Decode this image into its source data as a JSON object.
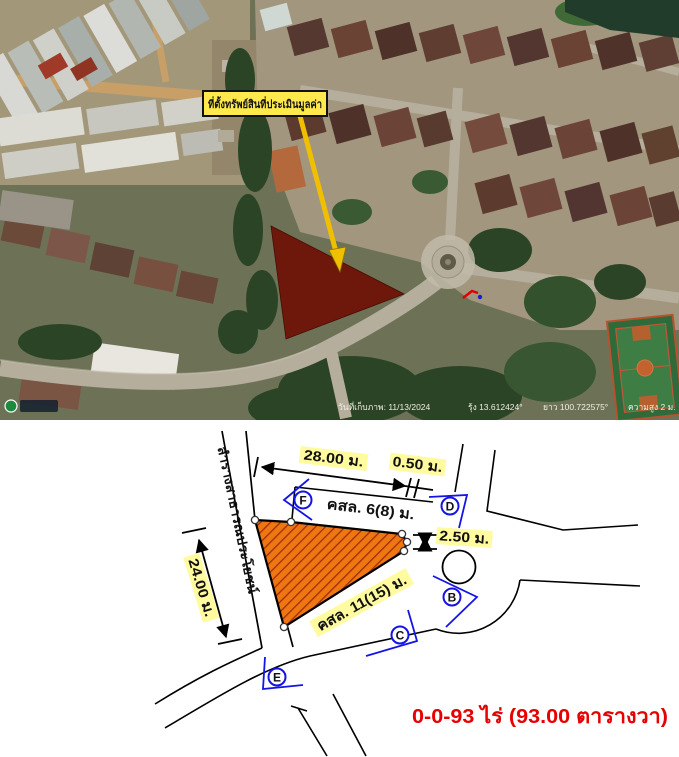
{
  "satellite_map": {
    "callout_label": "ที่ตั้งทรัพย์สินที่ประเมินมูลค่า",
    "status_parts": [
      "วันที่เก็บภาพ: 11/13/2024",
      "รุ้ง 13.612424°",
      "ยาว 100.722575°",
      "ความสูง 2 ม."
    ]
  },
  "survey_diagram": {
    "canal_label": "ลำรางสาธารณประโยชน์",
    "dimensions": {
      "top_width": "28.00 ม.",
      "top_offset": "0.50 ม.",
      "left_depth": "24.00 ม.",
      "right_frontage": "2.50 ม."
    },
    "roads": {
      "north_road": "คสล. 6(8) ม.",
      "south_road": "คสล. 11(15) ม."
    },
    "photo_markers": [
      "F",
      "D",
      "B",
      "C",
      "E"
    ],
    "area_text": "0-0-93 ไร่  (93.00 ตารางวา)",
    "colors": {
      "parcel_fill": "#ee7712",
      "parcel_hatch": "#9e2e08",
      "highlight": "#fffb9e",
      "marker_blue": "#1414e6",
      "area_red": "#e60000",
      "callout_yellow": "#ffe94d"
    }
  }
}
